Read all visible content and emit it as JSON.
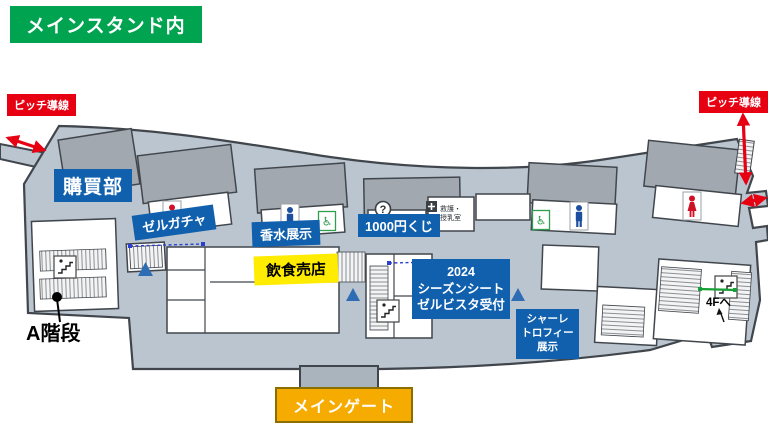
{
  "header": {
    "title": "メインスタンド内"
  },
  "annotations": {
    "pitch_route_left": "ピッチ導線",
    "pitch_route_right": "ピッチ導線",
    "purchase_dept": "購買部",
    "zel_gacha": "ゼルガチャ",
    "perfume_exhibit": "香水展示",
    "lottery_1000yen": "1000円くじ",
    "food_stall": "飲食売店",
    "season_seat": [
      "2024",
      "シーズンシート",
      "ゼルビスタ受付"
    ],
    "trophy_exhibit": [
      "シャーレ",
      "トロフィー",
      "展示"
    ],
    "a_stairs": "A階段",
    "main_gate": "メインゲート",
    "to_4f": "4Fへ",
    "first_aid_nursing": [
      "救護・",
      "授乳室"
    ]
  },
  "icons": {
    "wheelchair_glyph": "♿",
    "question_glyph": "?",
    "semantic_names": [
      "women-toilet-icon",
      "men-toilet-icon",
      "wheelchair-icon",
      "info-question-icon",
      "stairs-icon",
      "entrance-triangle-icon",
      "pitch-route-arrow",
      "first-aid-icon",
      "nursing-room-icon"
    ]
  },
  "colors": {
    "header_green": "#00A350",
    "label_blue": "#1060AE",
    "alert_red": "#E60012",
    "food_yellow": "#FFEC00",
    "gate_orange": "#F6AB00",
    "concourse_gray": "#BAC5D0",
    "block_gray": "#A2A8AF",
    "triangle_blue": "#2E6DB4",
    "stairs_green": "#18A038"
  }
}
